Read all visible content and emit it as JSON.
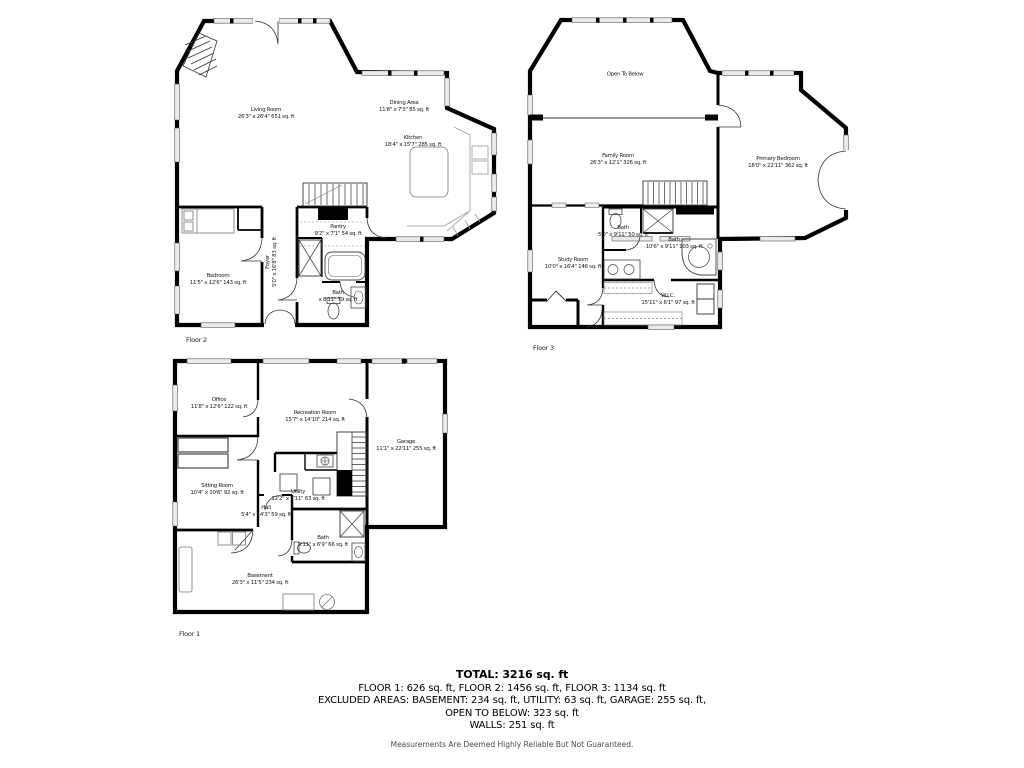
{
  "colors": {
    "wall": "#000000",
    "window_fill": "#ebebeb",
    "fixture_stroke": "#444444",
    "text": "#1a1a1a",
    "disclaimer_text": "#4a4a4a"
  },
  "floors": {
    "floor2": {
      "label": "Floor 2",
      "rooms": {
        "living": {
          "name": "Living Room",
          "dims": "26'3\" x 26'4\" 651 sq. ft"
        },
        "dining": {
          "name": "Dining Area",
          "dims": "11'8\" x 7'3\" 85 sq. ft"
        },
        "kitchen": {
          "name": "Kitchen",
          "dims": "18'4\" x 15'7\" 285 sq. ft"
        },
        "pantry": {
          "name": "Pantry",
          "dims": "9'2\" x 7'1\" 54 sq. ft"
        },
        "foyer": {
          "name": "Foyer",
          "dims": "5'0\" x 16'8\" 83 sq. ft"
        },
        "bedroom": {
          "name": "Bedroom",
          "dims": "11'5\" x 12'6\" 143 sq. ft"
        },
        "bath": {
          "name": "Bath",
          "dims": "x 8'11\" 79 sq. ft"
        }
      }
    },
    "floor3": {
      "label": "Floor 3",
      "rooms": {
        "open_to_below": {
          "name": "Open To Below"
        },
        "family": {
          "name": "Family Room",
          "dims": "26'3\" x 12'1\" 326 sq. ft"
        },
        "primary": {
          "name": "Primary Bedroom",
          "dims": "18'0\" x 22'11\" 362 sq. ft"
        },
        "bath_a": {
          "name": "Bath",
          "dims": "5'0\" x 9'11\" 50 sq. ft"
        },
        "bath_b": {
          "name": "Bath",
          "dims": "10'6\" x 9'11\" 103 sq. ft"
        },
        "study": {
          "name": "Study Room",
          "dims": "10'0\" x 16'4\" 146 sq. ft"
        },
        "wic": {
          "name": "W.I.C.",
          "dims": "15'11\" x 6'1\" 97 sq. ft"
        }
      }
    },
    "floor1": {
      "label": "Floor 1",
      "rooms": {
        "office": {
          "name": "Office",
          "dims": "11'8\" x 12'6\" 122 sq. ft"
        },
        "recreation": {
          "name": "Recreation Room",
          "dims": "15'7\" x 14'10\" 214 sq. ft"
        },
        "garage": {
          "name": "Garage",
          "dims": "11'1\" x 22'11\" 255 sq. ft"
        },
        "sitting": {
          "name": "Sitting Room",
          "dims": "10'4\" x 10'6\" 92 sq. ft"
        },
        "utility": {
          "name": "Utility",
          "dims": "12'2\" x 7'11\" 63 sq. ft"
        },
        "hall": {
          "name": "Hall",
          "dims": "5'4\" x 14'3\" 59 sq. ft"
        },
        "bath": {
          "name": "Bath",
          "dims": "9'11\" x 6'9\" 66 sq. ft"
        },
        "basement": {
          "name": "Basement",
          "dims": "26'3\" x 11'5\" 234 sq. ft"
        }
      }
    }
  },
  "summary": {
    "total": "TOTAL: 3216 sq. ft",
    "floors_line": "FLOOR 1: 626 sq. ft, FLOOR 2: 1456 sq. ft, FLOOR 3: 1134 sq. ft",
    "excluded_line": "EXCLUDED AREAS: BASEMENT: 234 sq. ft, UTILITY: 63 sq. ft, GARAGE: 255 sq. ft,",
    "open_below_line": "OPEN TO BELOW: 323 sq. ft",
    "walls_line": "WALLS: 251 sq. ft",
    "disclaimer": "Measurements Are Deemed Highly Reliable But Not Guaranteed."
  }
}
